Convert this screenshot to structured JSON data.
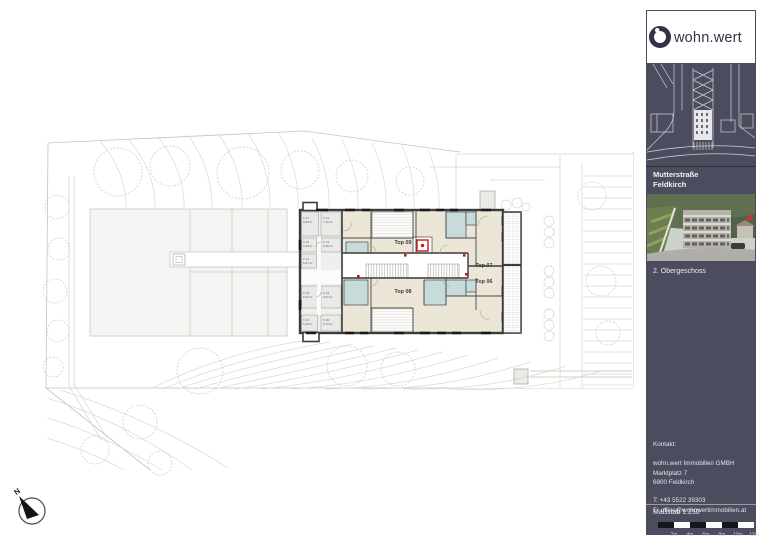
{
  "plan": {
    "compass_label": "N",
    "apartments": [
      {
        "label": "Top 09"
      },
      {
        "label": "Top 07"
      },
      {
        "label": "Top 06"
      },
      {
        "label": "Top 08"
      }
    ],
    "cellar_rooms": [
      {
        "id": "K 17",
        "area": "5,50m²"
      },
      {
        "id": "K 19",
        "area": "7,62m²"
      },
      {
        "id": "K 15",
        "area": "5,46m²"
      },
      {
        "id": "K 13",
        "area": "6,46m²"
      },
      {
        "id": "K 14",
        "area": "6,07m²"
      },
      {
        "id": "K 18",
        "area": "6,67m²"
      },
      {
        "id": "K 12",
        "area": "6,61m²"
      },
      {
        "id": "K 16",
        "area": "6,30m²"
      },
      {
        "id": "K 20",
        "area": "6,71m²"
      }
    ]
  },
  "sidebar": {
    "logo_text": "wohn.wert",
    "project_title_line1": "Mutterstraße",
    "project_title_line2": "Feldkirch",
    "floor_label": "2. Obergeschoss",
    "contact": {
      "heading": "Kontakt:",
      "company": "wohn.wert Immobilien GMBH",
      "street": "Marktplatz 7",
      "city": "6800 Feldkirch",
      "phone": "T: +43 5522 39303",
      "email": "E: office@wohnwertimmobilien.at"
    },
    "scale_label": "Maßstab 1:250",
    "scale_ticks": [
      "2m",
      "4m",
      "6m",
      "8m",
      "10m",
      "12m"
    ]
  },
  "colors": {
    "sidebar_navy": "#4b4c5e",
    "logo_navy": "#32334a",
    "room_beige": "#ece6d7",
    "bathroom_teal": "#c7dbda",
    "cellar_gray": "#e9e9e7",
    "wall_dark": "#3b3b3d",
    "accent_red": "#c81a1a",
    "site_line": "#d2cfc0"
  }
}
